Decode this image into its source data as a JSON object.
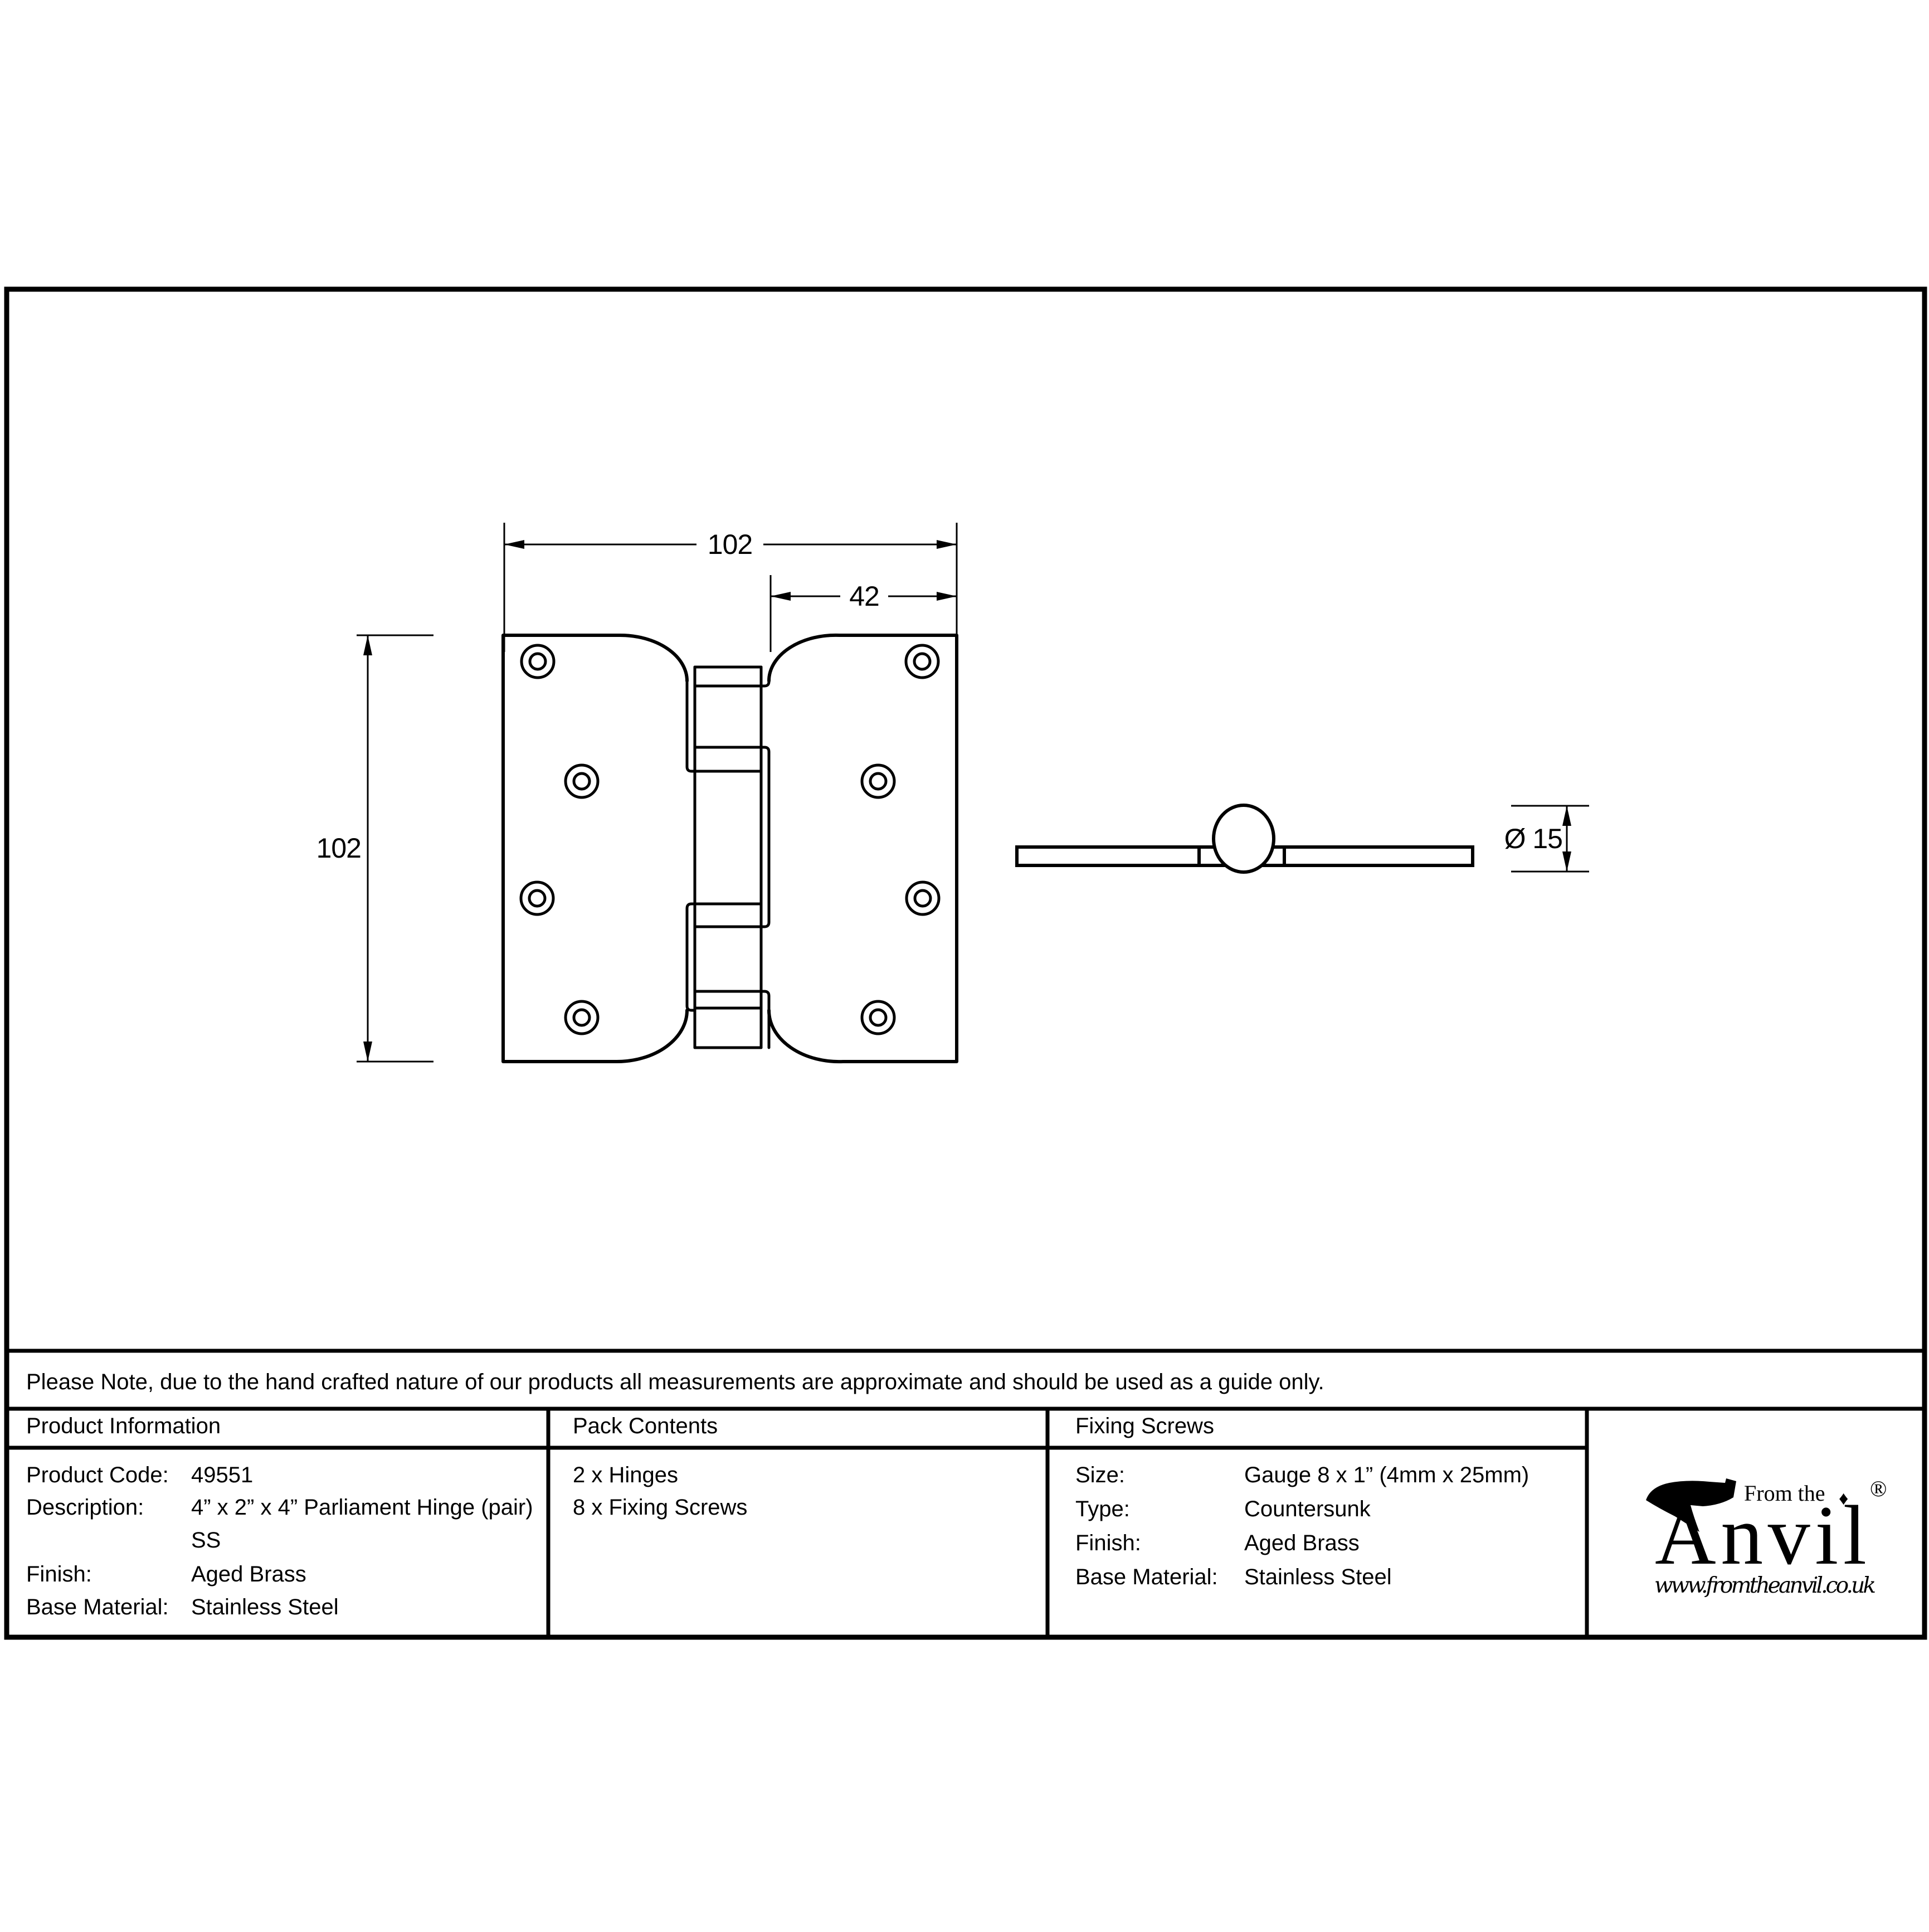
{
  "drawing": {
    "front_view": {
      "width_label": "102",
      "partial_width_label": "42",
      "height_label": "102"
    },
    "side_view": {
      "diameter_label": "Ø 15"
    }
  },
  "note": {
    "text": "Please Note, due to the hand crafted nature of our products all measurements are approximate and should be used as a guide only."
  },
  "table": {
    "product_information": {
      "header": "Product Information",
      "rows": [
        {
          "label": "Product Code:",
          "value": "49551"
        },
        {
          "label": "Description:",
          "value": "4” x 2” x 4” Parliament Hinge (pair)",
          "value2": "SS"
        },
        {
          "label": "Finish:",
          "value": "Aged Brass"
        },
        {
          "label": "Base Material:",
          "value": "Stainless Steel"
        }
      ]
    },
    "pack_contents": {
      "header": "Pack Contents",
      "items": [
        "2 x Hinges",
        "8 x Fixing Screws"
      ]
    },
    "fixing_screws": {
      "header": "Fixing Screws",
      "rows": [
        {
          "label": "Size:",
          "value": "Gauge 8 x 1” (4mm x 25mm)"
        },
        {
          "label": "Type:",
          "value": "Countersunk"
        },
        {
          "label": "Finish:",
          "value": "Aged Brass"
        },
        {
          "label": "Base Material:",
          "value": "Stainless Steel"
        }
      ]
    }
  },
  "logo": {
    "tagline": "From the",
    "brand": "Anvil",
    "registered": "®",
    "diamond": "♦",
    "url": "www.fromtheanvil.co.uk"
  },
  "colors": {
    "ink": "#000000",
    "paper": "#ffffff"
  }
}
